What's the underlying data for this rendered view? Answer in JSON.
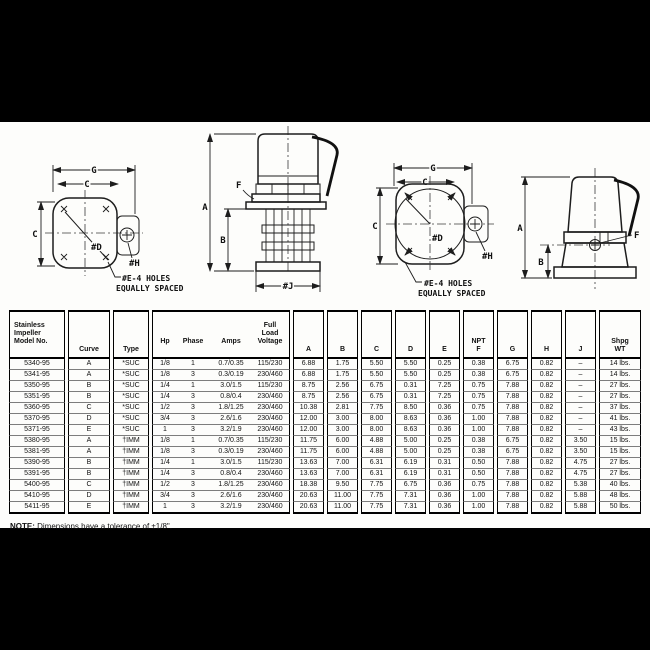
{
  "page": {
    "letterbox_color": "#000000",
    "paper_color": "#fdfdfb",
    "ink_color": "#111111"
  },
  "drawings": {
    "view1": {
      "g": "G",
      "c_top": "C",
      "c_left": "C",
      "d": "#D",
      "h": "#H",
      "holes1": "#E-4 HOLES",
      "holes2": "EQUALLY SPACED"
    },
    "view2": {
      "a": "A",
      "b": "B",
      "f": "F",
      "j": "#J"
    },
    "view3": {
      "g": "G",
      "c_top": "C",
      "c_left": "C",
      "d": "#D",
      "h": "#H",
      "holes1": "#E-4 HOLES",
      "holes2": "EQUALLY SPACED"
    },
    "view4": {
      "a": "A",
      "b": "B",
      "f": "F"
    }
  },
  "table": {
    "headers": {
      "model": "Stainless\nImpeller\nModel No.",
      "curve": "Curve",
      "type": "Type",
      "hp": "Hp",
      "phase": "Phase",
      "amps": "Amps",
      "voltage": "Full\nLoad\nVoltage",
      "a": "A",
      "b": "B",
      "c": "C",
      "d": "D",
      "e": "E",
      "f": "NPT\nF",
      "g": "G",
      "h": "H",
      "j": "J",
      "wt": "Shpg\nWT"
    },
    "rows": [
      {
        "model": "5340-95",
        "curve": "A",
        "type": "*SUC",
        "hp": "1/8",
        "phase": "1",
        "amps": "0.7/0.35",
        "voltage": "115/230",
        "a": "6.88",
        "b": "1.75",
        "c": "5.50",
        "d": "5.50",
        "e": "0.25",
        "f": "0.38",
        "g": "6.75",
        "h": "0.82",
        "j": "–",
        "wt": "14 lbs."
      },
      {
        "model": "5341-95",
        "curve": "A",
        "type": "*SUC",
        "hp": "1/8",
        "phase": "3",
        "amps": "0.3/0.19",
        "voltage": "230/460",
        "a": "6.88",
        "b": "1.75",
        "c": "5.50",
        "d": "5.50",
        "e": "0.25",
        "f": "0.38",
        "g": "6.75",
        "h": "0.82",
        "j": "–",
        "wt": "14 lbs."
      },
      {
        "model": "5350-95",
        "curve": "B",
        "type": "*SUC",
        "hp": "1/4",
        "phase": "1",
        "amps": "3.0/1.5",
        "voltage": "115/230",
        "a": "8.75",
        "b": "2.56",
        "c": "6.75",
        "d": "0.31",
        "e": "7.25",
        "f": "0.75",
        "g": "7.88",
        "h": "0.82",
        "j": "–",
        "wt": "27 lbs."
      },
      {
        "model": "5351-95",
        "curve": "B",
        "type": "*SUC",
        "hp": "1/4",
        "phase": "3",
        "amps": "0.8/0.4",
        "voltage": "230/460",
        "a": "8.75",
        "b": "2.56",
        "c": "6.75",
        "d": "0.31",
        "e": "7.25",
        "f": "0.75",
        "g": "7.88",
        "h": "0.82",
        "j": "–",
        "wt": "27 lbs."
      },
      {
        "model": "5360-95",
        "curve": "C",
        "type": "*SUC",
        "hp": "1/2",
        "phase": "3",
        "amps": "1.8/1.25",
        "voltage": "230/460",
        "a": "10.38",
        "b": "2.81",
        "c": "7.75",
        "d": "8.50",
        "e": "0.36",
        "f": "0.75",
        "g": "7.88",
        "h": "0.82",
        "j": "–",
        "wt": "37 lbs."
      },
      {
        "model": "5370-95",
        "curve": "D",
        "type": "*SUC",
        "hp": "3/4",
        "phase": "3",
        "amps": "2.6/1.6",
        "voltage": "230/460",
        "a": "12.00",
        "b": "3.00",
        "c": "8.00",
        "d": "8.63",
        "e": "0.36",
        "f": "1.00",
        "g": "7.88",
        "h": "0.82",
        "j": "–",
        "wt": "41 lbs."
      },
      {
        "model": "5371-95",
        "curve": "E",
        "type": "*SUC",
        "hp": "1",
        "phase": "3",
        "amps": "3.2/1.9",
        "voltage": "230/460",
        "a": "12.00",
        "b": "3.00",
        "c": "8.00",
        "d": "8.63",
        "e": "0.36",
        "f": "1.00",
        "g": "7.88",
        "h": "0.82",
        "j": "–",
        "wt": "43 lbs."
      },
      {
        "model": "5380-95",
        "curve": "A",
        "type": "†IMM",
        "hp": "1/8",
        "phase": "1",
        "amps": "0.7/0.35",
        "voltage": "115/230",
        "a": "11.75",
        "b": "6.00",
        "c": "4.88",
        "d": "5.00",
        "e": "0.25",
        "f": "0.38",
        "g": "6.75",
        "h": "0.82",
        "j": "3.50",
        "wt": "15 lbs."
      },
      {
        "model": "5381-95",
        "curve": "A",
        "type": "†IMM",
        "hp": "1/8",
        "phase": "3",
        "amps": "0.3/0.19",
        "voltage": "230/460",
        "a": "11.75",
        "b": "6.00",
        "c": "4.88",
        "d": "5.00",
        "e": "0.25",
        "f": "0.38",
        "g": "6.75",
        "h": "0.82",
        "j": "3.50",
        "wt": "15 lbs."
      },
      {
        "model": "5390-95",
        "curve": "B",
        "type": "†IMM",
        "hp": "1/4",
        "phase": "1",
        "amps": "3.0/1.5",
        "voltage": "115/230",
        "a": "13.63",
        "b": "7.00",
        "c": "6.31",
        "d": "6.19",
        "e": "0.31",
        "f": "0.50",
        "g": "7.88",
        "h": "0.82",
        "j": "4.75",
        "wt": "27 lbs."
      },
      {
        "model": "5391-95",
        "curve": "B",
        "type": "†IMM",
        "hp": "1/4",
        "phase": "3",
        "amps": "0.8/0.4",
        "voltage": "230/460",
        "a": "13.63",
        "b": "7.00",
        "c": "6.31",
        "d": "6.19",
        "e": "0.31",
        "f": "0.50",
        "g": "7.88",
        "h": "0.82",
        "j": "4.75",
        "wt": "27 lbs."
      },
      {
        "model": "5400-95",
        "curve": "C",
        "type": "†IMM",
        "hp": "1/2",
        "phase": "3",
        "amps": "1.8/1.25",
        "voltage": "230/460",
        "a": "18.38",
        "b": "9.50",
        "c": "7.75",
        "d": "6.75",
        "e": "0.36",
        "f": "0.75",
        "g": "7.88",
        "h": "0.82",
        "j": "5.38",
        "wt": "40 lbs."
      },
      {
        "model": "5410-95",
        "curve": "D",
        "type": "†IMM",
        "hp": "3/4",
        "phase": "3",
        "amps": "2.6/1.6",
        "voltage": "230/460",
        "a": "20.63",
        "b": "11.00",
        "c": "7.75",
        "d": "7.31",
        "e": "0.36",
        "f": "1.00",
        "g": "7.88",
        "h": "0.82",
        "j": "5.88",
        "wt": "48 lbs."
      },
      {
        "model": "5411-95",
        "curve": "E",
        "type": "†IMM",
        "hp": "1",
        "phase": "3",
        "amps": "3.2/1.9",
        "voltage": "230/460",
        "a": "20.63",
        "b": "11.00",
        "c": "7.75",
        "d": "7.31",
        "e": "0.36",
        "f": "1.00",
        "g": "7.88",
        "h": "0.82",
        "j": "5.88",
        "wt": "50 lbs."
      }
    ]
  },
  "note": {
    "label": "NOTE:",
    "text": "Dimensions have a tolerance of ±1/8\"."
  }
}
